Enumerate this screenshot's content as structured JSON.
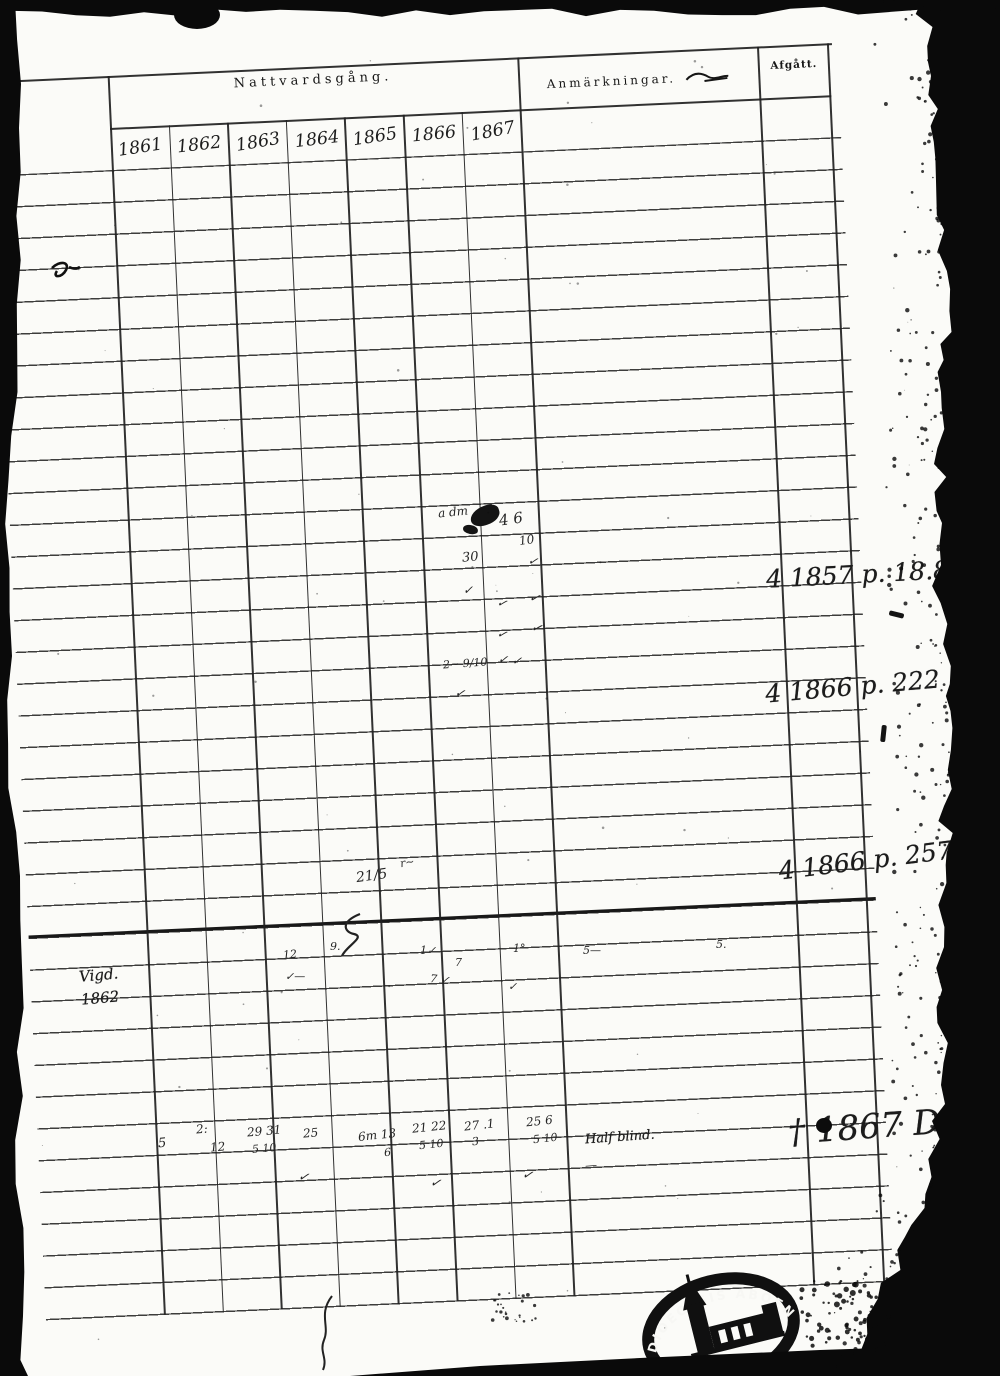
{
  "colors": {
    "paper": "#fbfbf8",
    "ink": "#1b1b1b"
  },
  "header": {
    "nattvardsgang": "Nattvardsgång.",
    "years": [
      "1861",
      "1862",
      "1863",
      "1864",
      "1865",
      "1866",
      "1867"
    ],
    "anmarkningar": "Anmärkningar.",
    "afgatt": "Afgått."
  },
  "annotations": {
    "note1": "4 1857 p. 18.8",
    "note2": "4 1866 p. 222",
    "note3": "4 1866 p. 257",
    "note4": "† 1867 Död",
    "remark_blind": "Half blind.",
    "margin_note_line1": "Vigd.",
    "margin_note_line2": "1862"
  },
  "stamp": {
    "text": "DIOECESIS ABOENSIS",
    "icon": "church-icon"
  },
  "handwriting": {
    "marks": [
      {
        "x": 438,
        "y": 505,
        "t": "a dm",
        "s": 12,
        "r": -6
      },
      {
        "x": 499,
        "y": 510,
        "t": "4 6",
        "s": 15,
        "r": -8
      },
      {
        "x": 519,
        "y": 533,
        "t": "10",
        "s": 12,
        "r": -8
      },
      {
        "x": 462,
        "y": 550,
        "t": "30",
        "s": 13,
        "r": -5
      },
      {
        "x": 528,
        "y": 554,
        "t": "✓",
        "s": 12,
        "r": 12
      },
      {
        "x": 463,
        "y": 583,
        "t": "✓",
        "s": 12,
        "r": 0
      },
      {
        "x": 497,
        "y": 596,
        "t": "✓",
        "s": 12,
        "r": 16
      },
      {
        "x": 529,
        "y": 591,
        "t": "✓",
        "s": 13,
        "r": 16
      },
      {
        "x": 497,
        "y": 627,
        "t": "✓",
        "s": 12,
        "r": 16
      },
      {
        "x": 531,
        "y": 621,
        "t": "✓",
        "s": 13,
        "r": 16
      },
      {
        "x": 443,
        "y": 657,
        "t": "2~ 9/10",
        "s": 11,
        "r": -4
      },
      {
        "x": 498,
        "y": 653,
        "t": "✓  ✓",
        "s": 12,
        "r": 6
      },
      {
        "x": 455,
        "y": 686,
        "t": "✓",
        "s": 12,
        "r": 10
      },
      {
        "x": 356,
        "y": 868,
        "t": "21/5",
        "s": 14,
        "r": -8
      },
      {
        "x": 400,
        "y": 856,
        "t": "r~",
        "s": 11,
        "r": -10
      },
      {
        "x": 283,
        "y": 948,
        "t": "12",
        "s": 11,
        "r": -5
      },
      {
        "x": 330,
        "y": 940,
        "t": "9.",
        "s": 11,
        "r": 0
      },
      {
        "x": 420,
        "y": 944,
        "t": "1✓",
        "s": 11,
        "r": 0
      },
      {
        "x": 455,
        "y": 956,
        "t": "7",
        "s": 11,
        "r": 0
      },
      {
        "x": 513,
        "y": 942,
        "t": "1°",
        "s": 11,
        "r": 0
      },
      {
        "x": 583,
        "y": 944,
        "t": "5—",
        "s": 11,
        "r": 0
      },
      {
        "x": 716,
        "y": 938,
        "t": "5.",
        "s": 11,
        "r": 0
      },
      {
        "x": 285,
        "y": 970,
        "t": "✓—",
        "s": 11,
        "r": 0
      },
      {
        "x": 430,
        "y": 973,
        "t": "7 ✓",
        "s": 11,
        "r": 6
      },
      {
        "x": 508,
        "y": 980,
        "t": "✓",
        "s": 11,
        "r": 0
      },
      {
        "x": 158,
        "y": 1136,
        "t": "5",
        "s": 13,
        "r": -5
      },
      {
        "x": 196,
        "y": 1122,
        "t": "2:",
        "s": 12,
        "r": -5
      },
      {
        "x": 210,
        "y": 1140,
        "t": "12",
        "s": 12,
        "r": -5
      },
      {
        "x": 247,
        "y": 1124,
        "t": "29 31",
        "s": 12,
        "r": -5
      },
      {
        "x": 252,
        "y": 1142,
        "t": "5  10",
        "s": 11,
        "r": -5
      },
      {
        "x": 303,
        "y": 1126,
        "t": "25",
        "s": 12,
        "r": -5
      },
      {
        "x": 358,
        "y": 1128,
        "t": "6m 13",
        "s": 12,
        "r": -6
      },
      {
        "x": 384,
        "y": 1146,
        "t": "6",
        "s": 11,
        "r": -5
      },
      {
        "x": 412,
        "y": 1120,
        "t": "21 22",
        "s": 12,
        "r": -6
      },
      {
        "x": 419,
        "y": 1138,
        "t": "5  10",
        "s": 11,
        "r": -6
      },
      {
        "x": 464,
        "y": 1118,
        "t": "27 .1",
        "s": 12,
        "r": -6
      },
      {
        "x": 472,
        "y": 1135,
        "t": "3",
        "s": 11,
        "r": -6
      },
      {
        "x": 526,
        "y": 1114,
        "t": "25  6",
        "s": 12,
        "r": -6
      },
      {
        "x": 533,
        "y": 1132,
        "t": "5   10",
        "s": 11,
        "r": -6
      },
      {
        "x": 298,
        "y": 1170,
        "t": "✓",
        "s": 13,
        "r": 10
      },
      {
        "x": 430,
        "y": 1176,
        "t": "✓",
        "s": 13,
        "r": 10
      },
      {
        "x": 522,
        "y": 1168,
        "t": "✓",
        "s": 13,
        "r": 10
      },
      {
        "x": 585,
        "y": 1158,
        "t": "—",
        "s": 12,
        "r": -5
      }
    ]
  }
}
